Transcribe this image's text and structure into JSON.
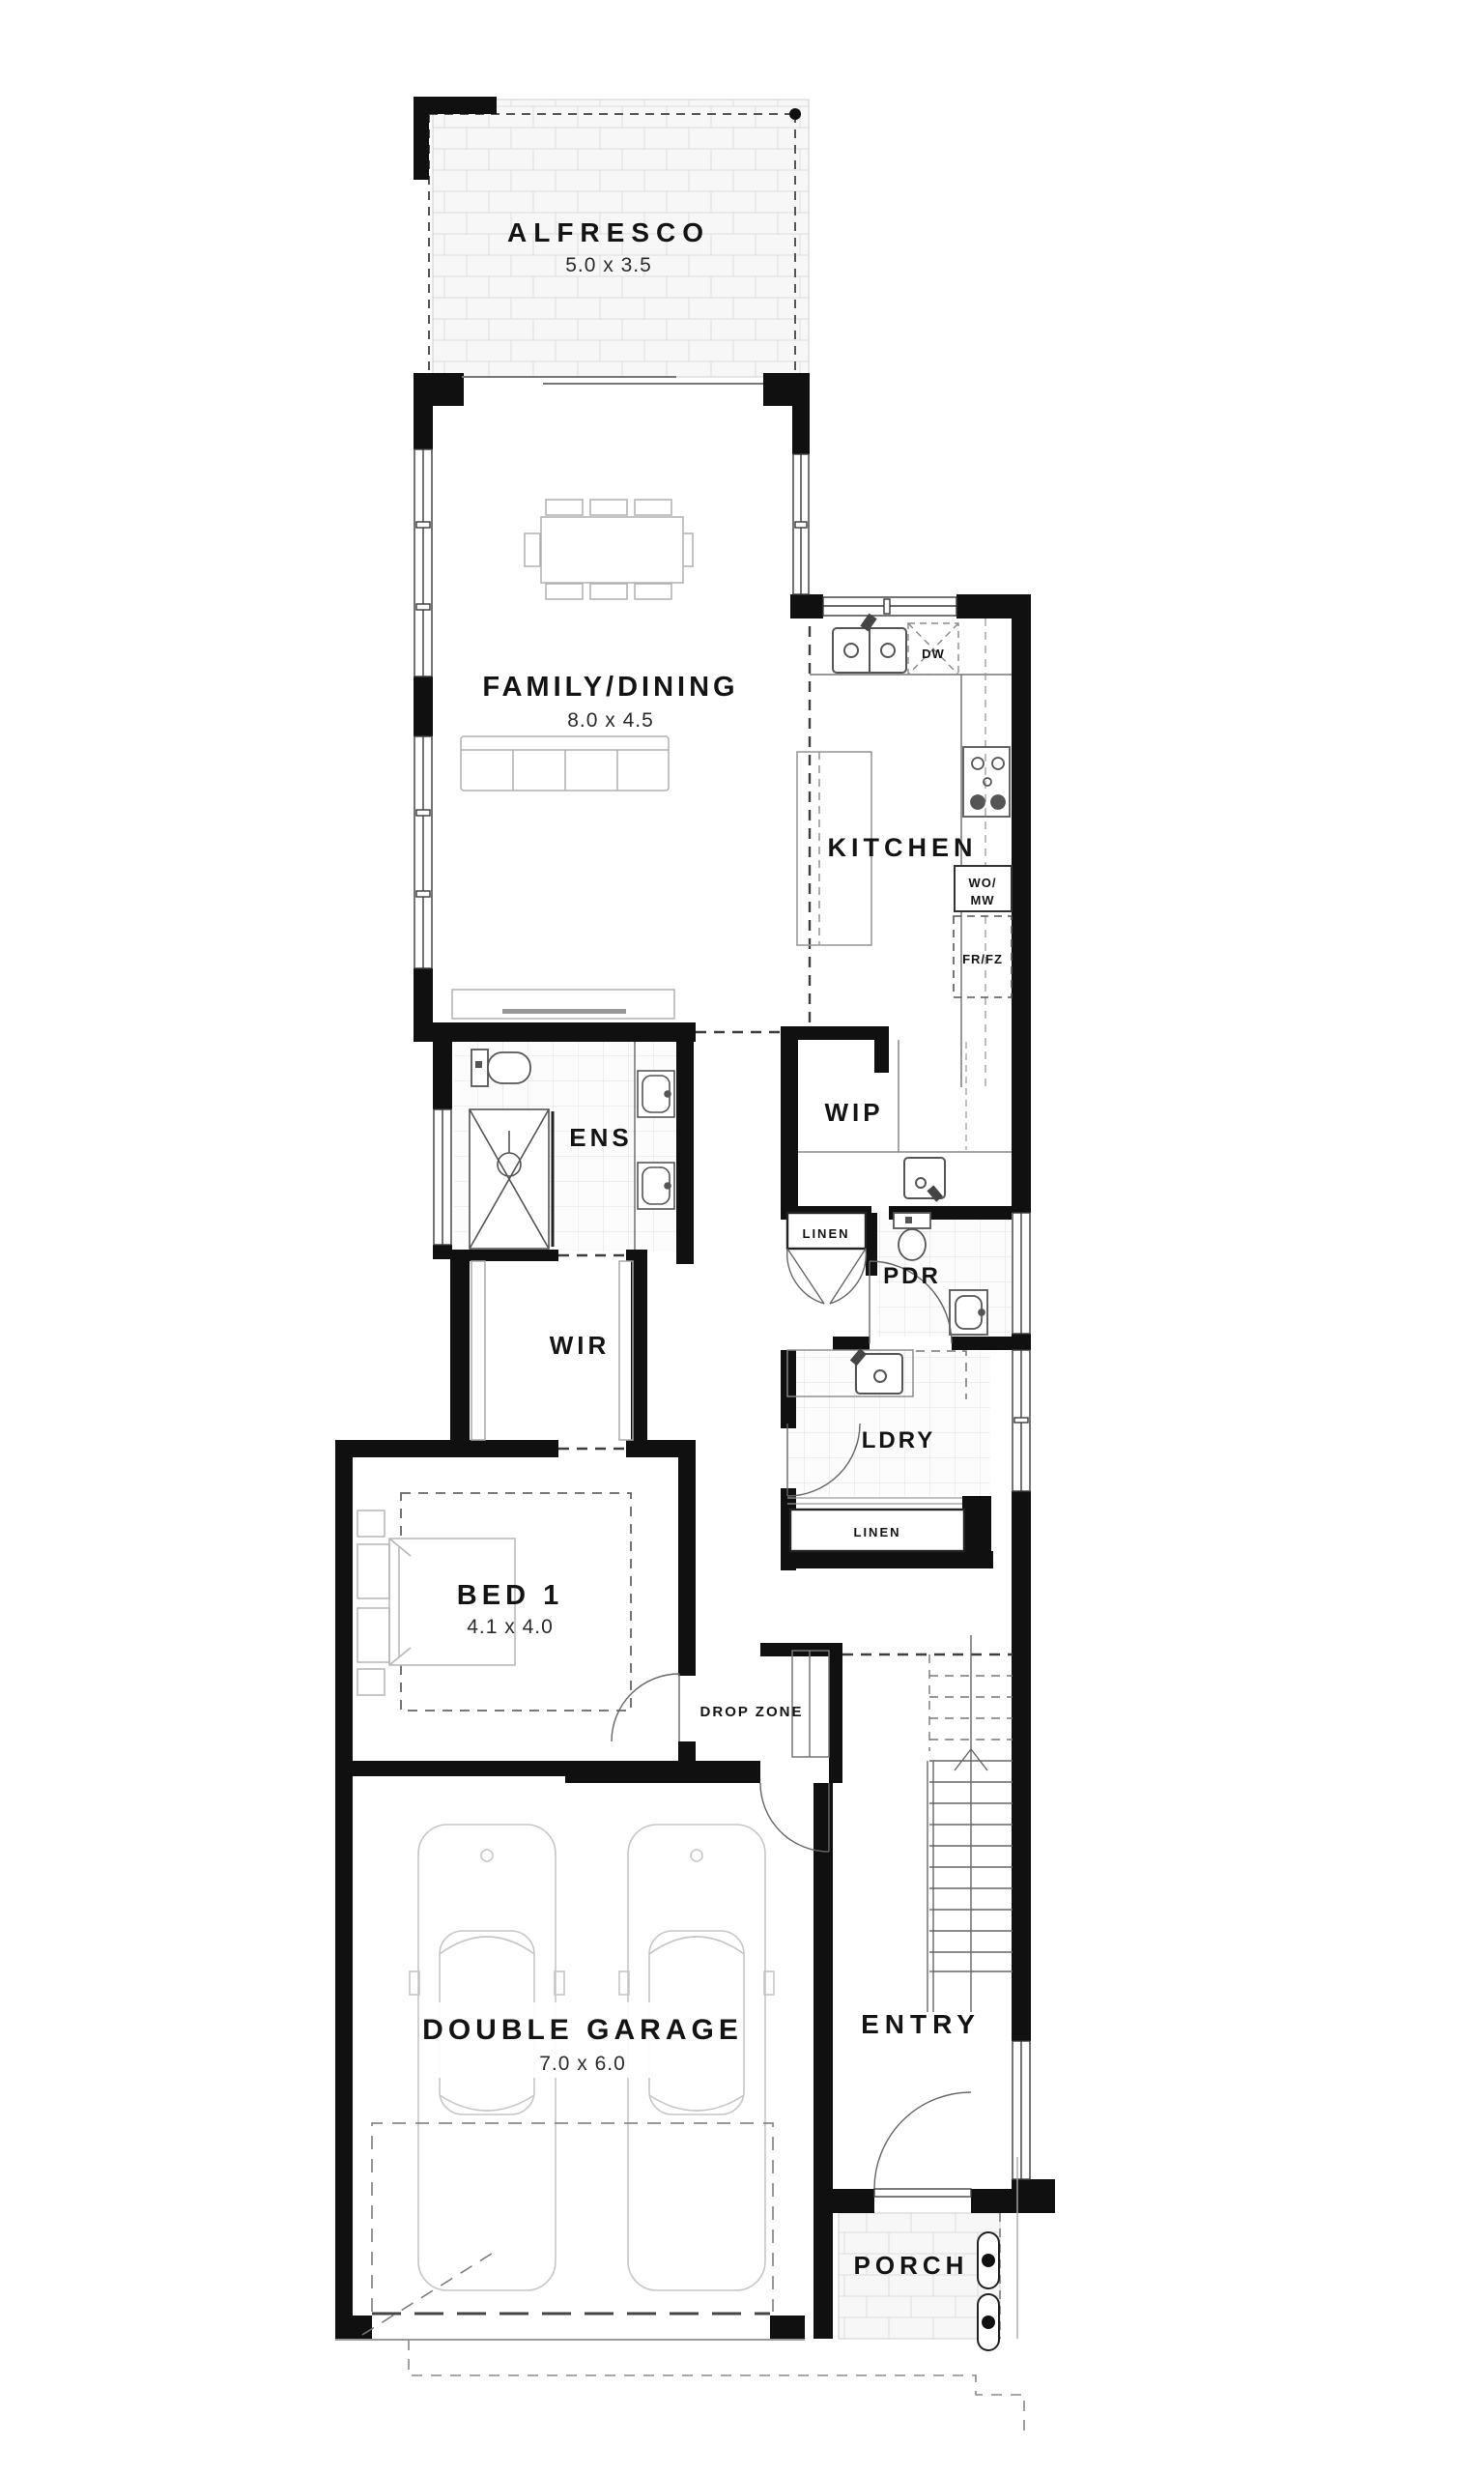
{
  "rooms": {
    "alfresco": {
      "label": "ALFRESCO",
      "dims": "5.0 x 3.5"
    },
    "family_dining": {
      "label": "FAMILY/DINING",
      "dims": "8.0 x 4.5"
    },
    "kitchen": {
      "label": "KITCHEN"
    },
    "wip": {
      "label": "WIP"
    },
    "ens": {
      "label": "ENS"
    },
    "wir": {
      "label": "WIR"
    },
    "pdr": {
      "label": "PDR"
    },
    "linen_upper": {
      "label": "LINEN"
    },
    "ldry": {
      "label": "LDRY"
    },
    "linen_lower": {
      "label": "LINEN"
    },
    "bed1": {
      "label": "BED 1",
      "dims": "4.1 x 4.0"
    },
    "drop_zone": {
      "label": "DROP ZONE"
    },
    "garage": {
      "label": "DOUBLE GARAGE",
      "dims": "7.0 x 6.0"
    },
    "entry": {
      "label": "ENTRY"
    },
    "porch": {
      "label": "PORCH"
    }
  },
  "appliances": {
    "dishwasher": {
      "label": "DW"
    },
    "wall_oven_microwave": {
      "line1": "WO/",
      "line2": "MW"
    },
    "fridge_freezer": {
      "label": "FR/FZ"
    }
  },
  "colors": {
    "wall": "#101010",
    "fixture": "#555555",
    "furniture": "#b0b0b0",
    "text": "#141414"
  }
}
